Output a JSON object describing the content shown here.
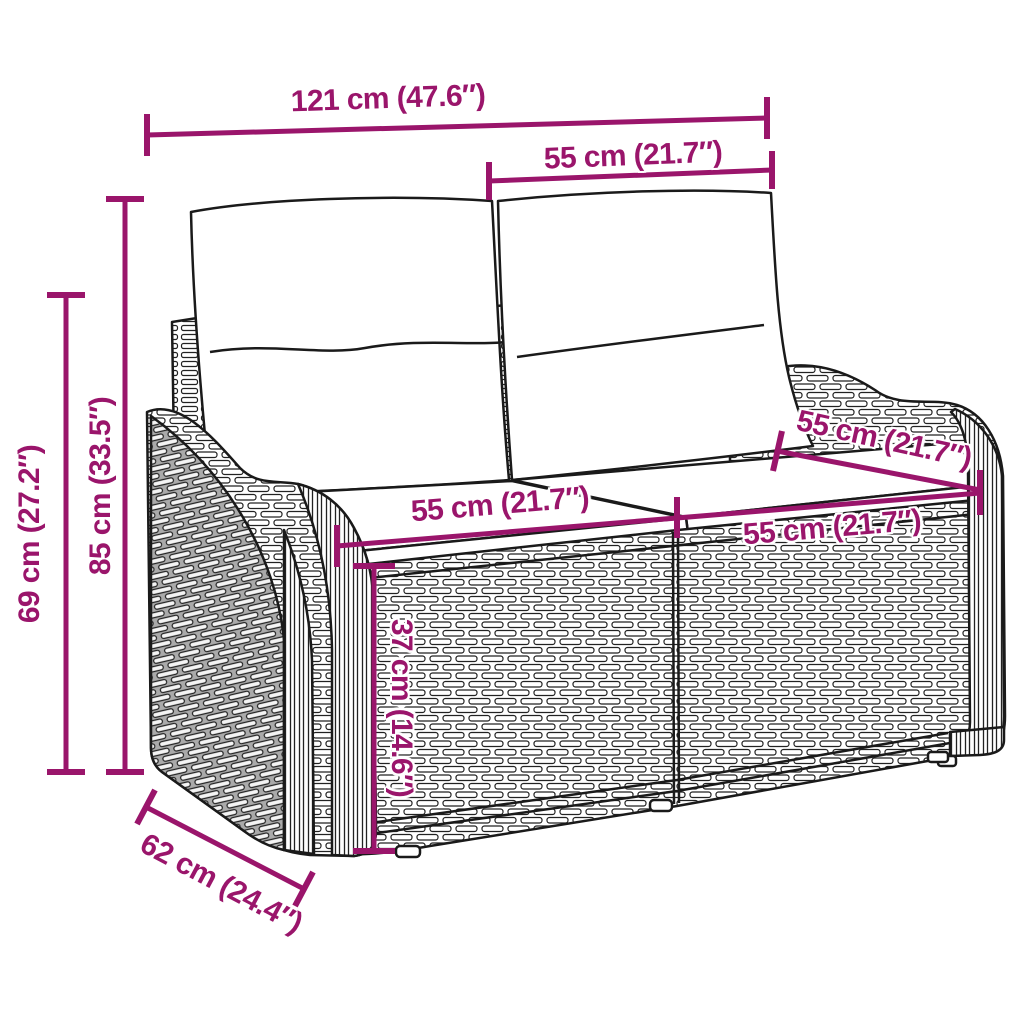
{
  "colors": {
    "accent": "#9A156B",
    "ink": "#1a1a1a",
    "background": "#ffffff"
  },
  "dimensions": [
    {
      "id": "total-width",
      "label": "121 cm (47.6″)"
    },
    {
      "id": "backrest-section-width",
      "label": "55 cm (21.7″)"
    },
    {
      "id": "total-height",
      "label": "85 cm (33.5″)"
    },
    {
      "id": "side-height",
      "label": "69 cm (27.2″)"
    },
    {
      "id": "seat-width-left",
      "label": "55 cm (21.7″)"
    },
    {
      "id": "seat-width-right",
      "label": "55 cm (21.7″)"
    },
    {
      "id": "seat-depth",
      "label": "55 cm (21.7″)"
    },
    {
      "id": "seat-height",
      "label": "37 cm (14.6″)"
    },
    {
      "id": "base-depth",
      "label": "62 cm (24.4″)"
    }
  ]
}
